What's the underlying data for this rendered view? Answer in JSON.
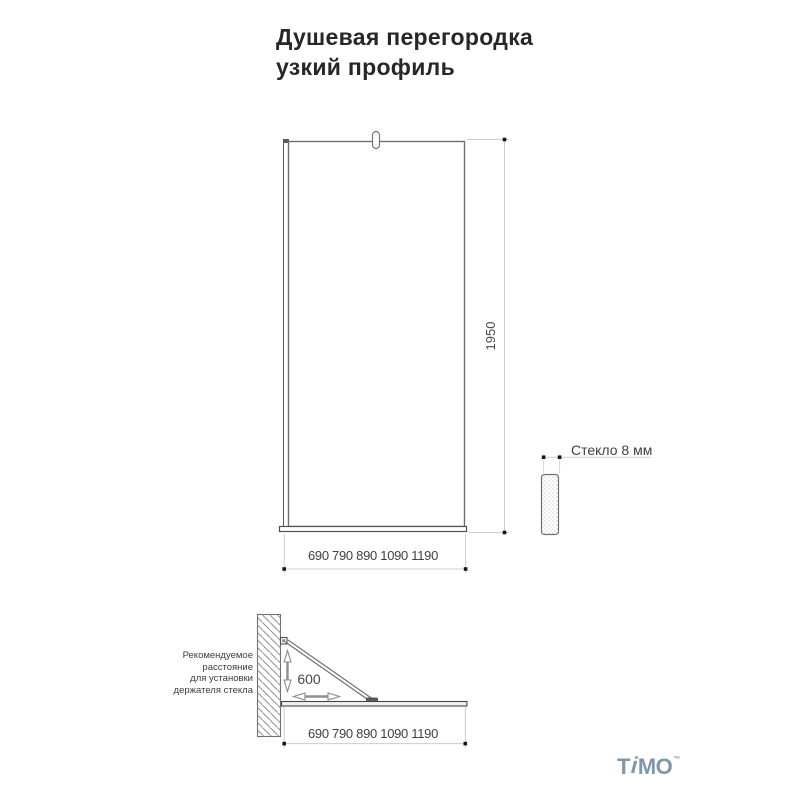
{
  "title": {
    "line1": "Душевая перегородка",
    "line2": "узкий профиль"
  },
  "front_view": {
    "height_dim": "1950",
    "width_dims": "690 790 890 1090 1190",
    "glass_label": "Стекло 8 мм"
  },
  "plan_view": {
    "holder_dim": "600",
    "width_dims": "690 790 890 1090 1190",
    "note_lines": [
      "Рекомендуемое",
      "расстояние",
      "для установки",
      "держателя стекла"
    ]
  },
  "logo": {
    "part1": "T",
    "part2": "i",
    "part3": "MO",
    "tm": "™"
  },
  "colors": {
    "outline_dark": "#4f4f4f",
    "outline_mid": "#6e6e6e",
    "dim_line": "#cccccc",
    "dim_dot": "#161616",
    "arrow": "#8f8f8f",
    "text": "#3c3c3c",
    "logo": "#7E98AA"
  }
}
